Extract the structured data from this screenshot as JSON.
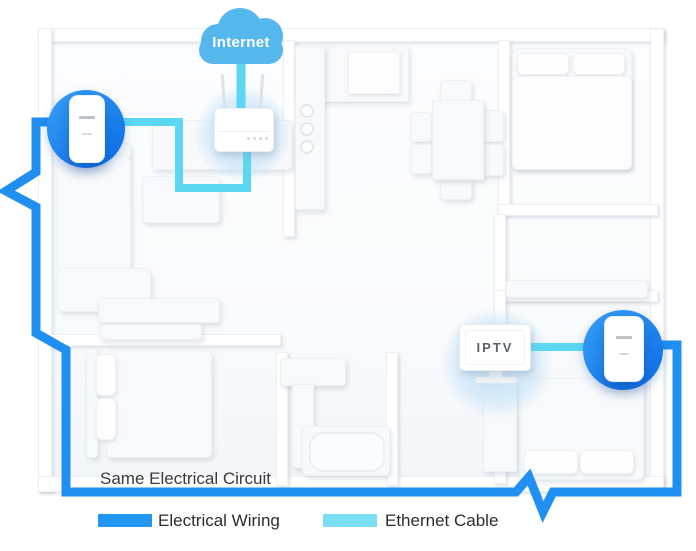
{
  "labels": {
    "internet": "Internet",
    "iptv": "IPTV",
    "same_circuit": "Same Electrical Circuit"
  },
  "legend": {
    "items": [
      {
        "label": "Electrical Wiring",
        "color": "#2196f3"
      },
      {
        "label": "Ethernet Cable",
        "color": "#7adef5"
      }
    ]
  },
  "colors": {
    "cloud_blue": "#55b7eb",
    "electrical_wiring": "#1f8ff2",
    "ethernet_cable": "#5cd7f2",
    "adapter_circle_start": "#38a1f7",
    "adapter_circle_end": "#0a6be5",
    "label_text": "#3a3a3a"
  },
  "icons": {
    "cloud": "internet-cloud-icon",
    "router": "wifi-router-icon",
    "adapter": "powerline-adapter-icon",
    "tv": "iptv-television-icon"
  }
}
